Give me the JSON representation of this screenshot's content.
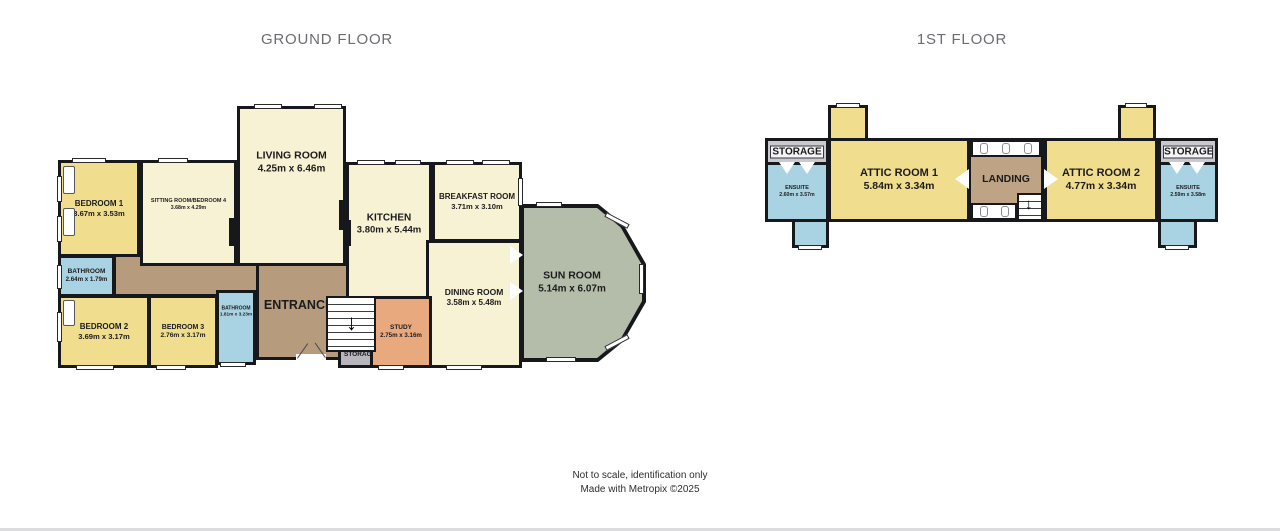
{
  "titles": {
    "ground": "GROUND FLOOR",
    "first": "1ST FLOOR"
  },
  "footer": {
    "line1": "Not to scale, identification only",
    "line2": "Made with Metropix ©2025"
  },
  "colors": {
    "yellow": "#f0dd8e",
    "cream": "#f8f2d4",
    "blue": "#a9d3e2",
    "hall_brown": "#b69b7d",
    "study_orange": "#e9a97e",
    "storage_gray": "#b6b6bc",
    "sunroom_green": "#b4bda9",
    "wall": "#16181c"
  },
  "ground_floor": {
    "rooms": {
      "bedroom1": {
        "name": "BEDROOM 1",
        "dims": "3.67m x 3.53m"
      },
      "sitting": {
        "name": "SITTING ROOM/BEDROOM 4",
        "dims": "3.68m x 4.29m"
      },
      "living": {
        "name": "LIVING ROOM",
        "dims": "4.25m x 6.46m"
      },
      "kitchen": {
        "name": "KITCHEN",
        "dims": "3.80m x 5.44m"
      },
      "breakfast": {
        "name": "BREAKFAST ROOM",
        "dims": "3.71m x 3.10m"
      },
      "sunroom": {
        "name": "SUN ROOM",
        "dims": "5.14m x 6.07m"
      },
      "dining": {
        "name": "DINING ROOM",
        "dims": "3.58m x 5.48m"
      },
      "bathroom1": {
        "name": "BATHROOM",
        "dims": "2.64m x 1.79m"
      },
      "bedroom2": {
        "name": "BEDROOM 2",
        "dims": "3.69m x 3.17m"
      },
      "bedroom3": {
        "name": "BEDROOM 3",
        "dims": "2.76m x 3.17m"
      },
      "bathroom2": {
        "name": "BATHROOM",
        "dims": "1.81m x 3.23m"
      },
      "hall": {
        "name": "ENTRANCE HALL"
      },
      "study": {
        "name": "STUDY",
        "dims": "2.75m x 3.16m"
      },
      "storage": {
        "name": "STORAGE"
      }
    }
  },
  "first_floor": {
    "rooms": {
      "storage_left": {
        "name": "STORAGE"
      },
      "ensuite_left": {
        "name": "ENSUITE",
        "dims": "2.60m x 3.57m"
      },
      "attic1": {
        "name": "ATTIC ROOM 1",
        "dims": "5.84m x 3.34m"
      },
      "landing": {
        "name": "LANDING"
      },
      "attic2": {
        "name": "ATTIC ROOM 2",
        "dims": "4.77m x 3.34m"
      },
      "storage_right": {
        "name": "STORAGE"
      },
      "ensuite_right": {
        "name": "ENSUITE",
        "dims": "2.59m x 3.58m"
      }
    }
  }
}
